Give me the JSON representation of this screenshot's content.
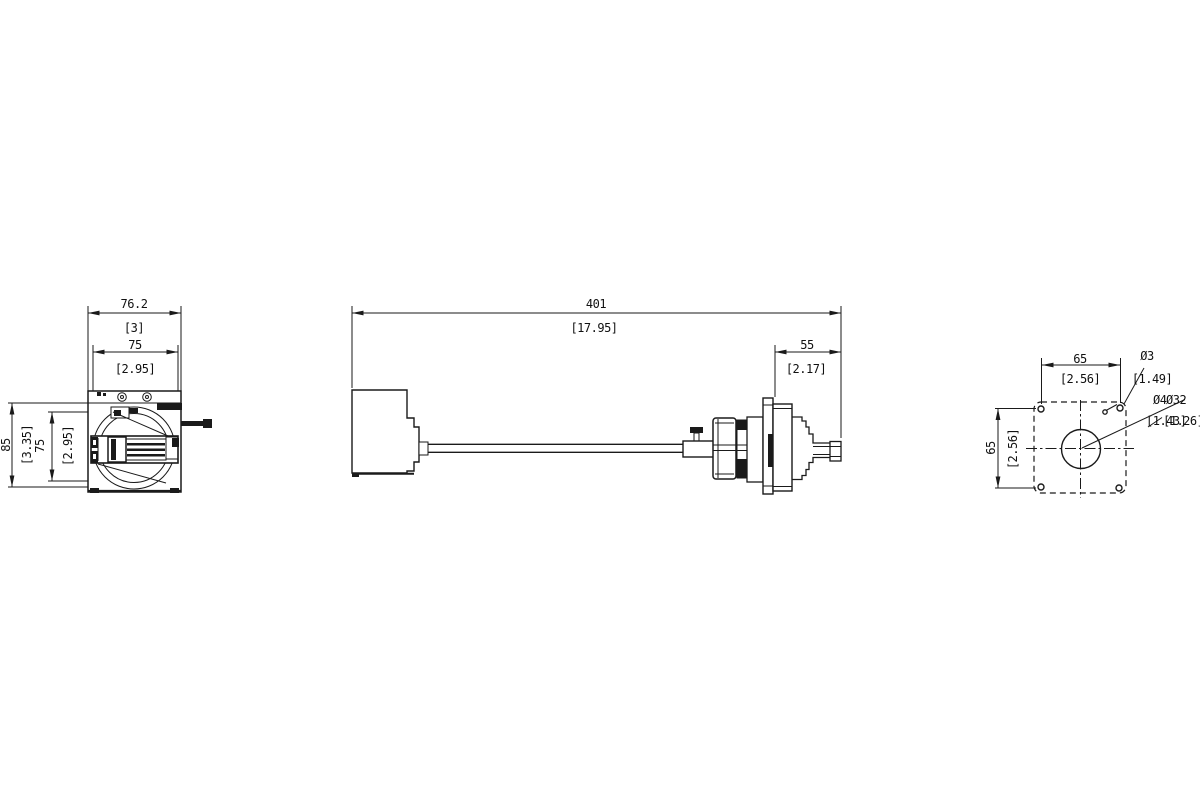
{
  "drawing": {
    "colors": {
      "line": "#1a1a1a",
      "background": "#ffffff"
    },
    "front_view": {
      "width_outer_mm": "76.2",
      "width_outer_in": "[3]",
      "width_inner_mm": "75",
      "width_inner_in": "[2.95]",
      "height_outer_mm": "85",
      "height_outer_in": "[3.35]",
      "height_inner_mm": "75",
      "height_inner_in": "[2.95]"
    },
    "side_view": {
      "overall_length_mm": "401",
      "overall_length_in": "[17.95]",
      "coupling_length_mm": "55",
      "coupling_length_in": "[2.17]"
    },
    "mounting_view": {
      "hole_pitch_h_mm": "65",
      "hole_pitch_h_in": "[2.56]",
      "hole_pitch_v_mm": "65",
      "hole_pitch_v_in": "[2.56]",
      "corner_hole_mm": "Ø3",
      "corner_hole_in": "[1.49]",
      "center_hole_a_mm": "Ø4",
      "center_hole_a_in": "[1.43]",
      "center_hole_b_mm": "Ø32",
      "center_hole_b_in": "[1.26]"
    }
  }
}
